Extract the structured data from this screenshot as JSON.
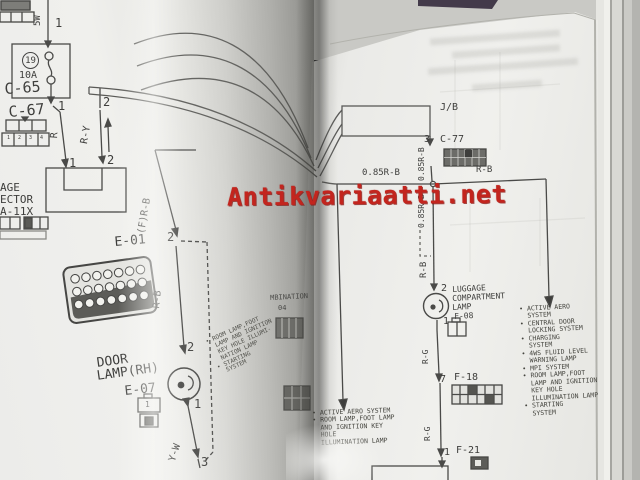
{
  "watermark": {
    "text": "Antikvariaatti.net",
    "color": "#c3251e"
  },
  "colors": {
    "paper": "#ededea",
    "ink": "#3e3e3c",
    "watermark_red": "#c3251e"
  },
  "icons": {
    "lamp_symbol": "circle-with-filament",
    "fuse_symbol": "two-circles-link",
    "connector_blocks": "pin-grid-rectangles",
    "junction": "small-open-circle",
    "flow_arrows": "filled-triangles"
  },
  "left_page": {
    "c65_label": "C-65",
    "c65_pin": "1",
    "bulb_rating": "5W",
    "fuse_number": "19",
    "fuse_rating": "10A",
    "c67_label": "C-67",
    "c67_pin_numbers": [
      "1",
      "2",
      "3",
      "4"
    ],
    "top_pin_1": "1",
    "top_pin_2": "2",
    "mid_pin_1": "1",
    "mid_pin_2": "2",
    "wire_r": "R",
    "wire_ry": "R-Y",
    "connector_fragment": {
      "line1": "AGE",
      "line2": "ECTOR",
      "line3": "A-11X"
    },
    "wire_frb": "(F)R-B",
    "e01_label": "E-01",
    "e01_pin": "2",
    "wire_rb": "R-B",
    "door_lamp": {
      "pin_top": "2",
      "name_line1": "DOOR",
      "name_line2": "LAMP(RH)",
      "code": "E-07",
      "connector_pin": "1",
      "pin_bottom": "1",
      "wire": "Y-W",
      "end_pin": "3"
    },
    "spine_fragment_text": "MBINATION",
    "spine_fragment_number": "04",
    "curl_list": [
      "• ROOM LAMP,FOOT",
      "  LAMP AND IGNITION",
      "  KEY HOLE ILLUMI-",
      "  NATION LAMP",
      "• STARTING",
      "  SYSTEM"
    ]
  },
  "right_page": {
    "jb_label": "J/B",
    "c77_pin": "3",
    "c77_label": "C-77",
    "wire_085_top": "0.85R-B",
    "wire_085_horizontal": "0.85R-B",
    "wire_085_down": "0.85R-B",
    "wire_rb_right": "R-B",
    "wire_rb_down": "R-B",
    "luggage_lamp": {
      "pin_top": "2",
      "name_line1": "LUGGAGE",
      "name_line2": "COMPARTMENT",
      "name_line3": "LAMP",
      "code": "F-08",
      "pin_bottom": "1"
    },
    "wire_rg_upper": "R-G",
    "f18_pin": "7",
    "f18_label": "F-18",
    "wire_rg_lower": "R-G",
    "f21_pin": "1",
    "f21_label": "F-21",
    "center_list": [
      "• ACTIVE AERO SYSTEM",
      "• ROOM LAMP,FOOT LAMP",
      "  AND IGNITION KEY",
      "  HOLE",
      "  ILLUMINATION LAMP"
    ],
    "right_list": [
      "• ACTIVE AERO",
      "  SYSTEM",
      "• CENTRAL DOOR",
      "  LOCKING SYSTEM",
      "• CHARGING",
      "  SYSTEM",
      "• 4WS FLUID LEVEL",
      "  WARNING LAMP",
      "• MPI SYSTEM",
      "• ROOM LAMP,FOOT",
      "  LAMP AND IGNITION",
      "  KEY HOLE",
      "  ILLUMINATION LAMP",
      "• STARTING",
      "  SYSTEM"
    ]
  }
}
